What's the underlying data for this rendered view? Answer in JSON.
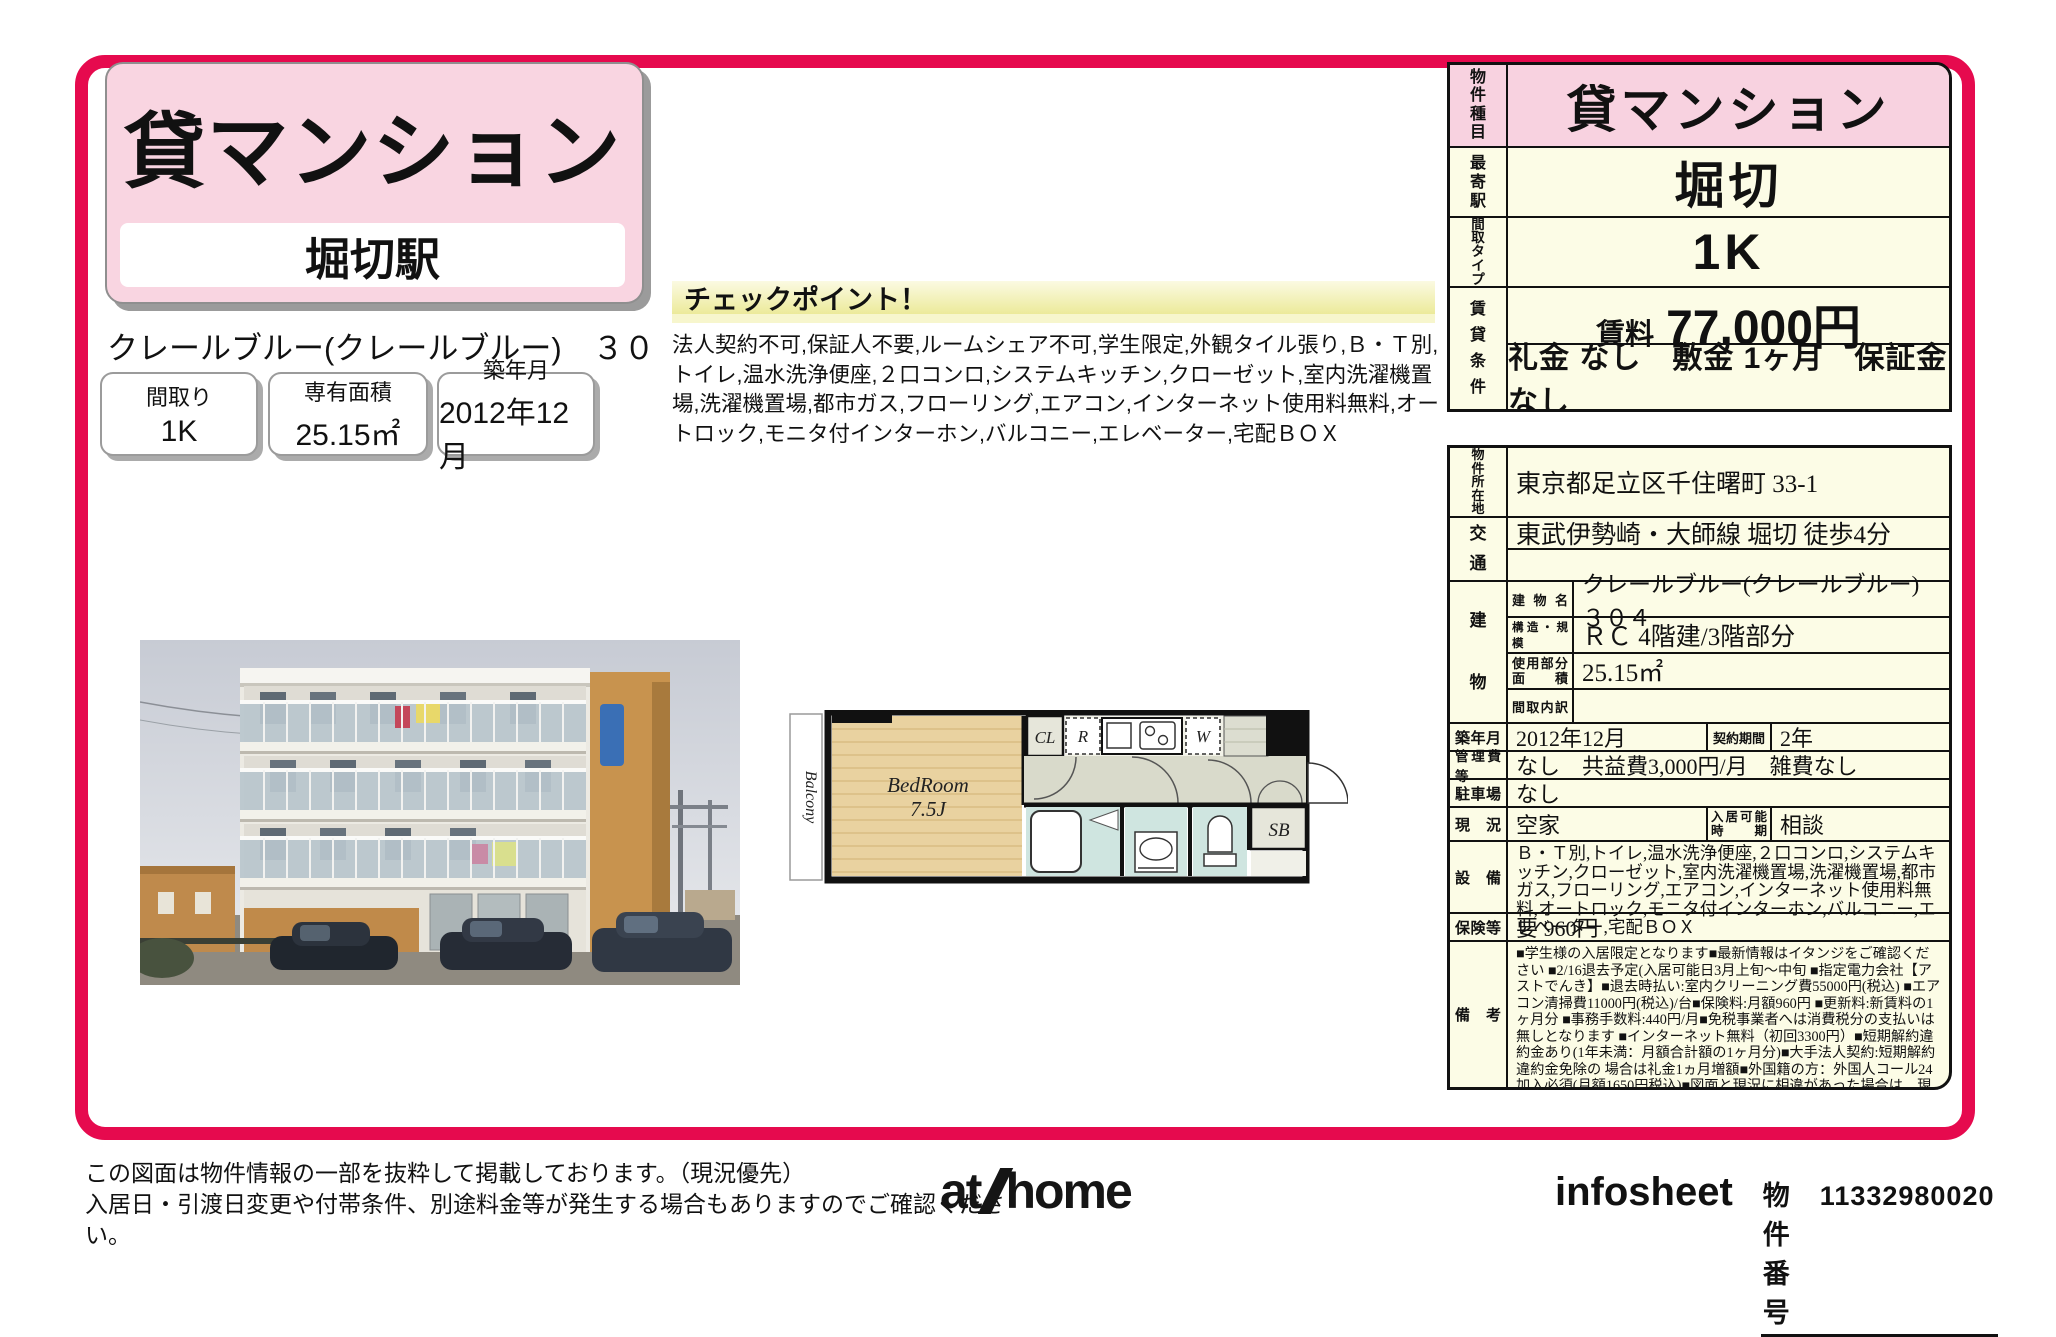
{
  "colors": {
    "accent_red": "#e60a4e",
    "title_pink": "#f9d5e1",
    "table_pink": "#f8d2e0",
    "table_cream": "#fcfce6",
    "checkpoint_yellow": "#ecea9a"
  },
  "header": {
    "property_type": "貸マンション",
    "station": "堀切駅",
    "property_name": "クレールブルー(クレールブルー)　３０４",
    "specs": [
      {
        "label": "間取り",
        "value": "1K"
      },
      {
        "label": "専有面積",
        "value": "25.15㎡"
      },
      {
        "label": "築年月",
        "value": "2012年12月"
      }
    ]
  },
  "checkpoint": {
    "title": "チェックポイント！",
    "body": "法人契約不可,保証人不要,ルームシェア不可,学生限定,外観タイル張り,Ｂ・Ｔ別,トイレ,温水洗浄便座,２口コンロ,システムキッチン,クローゼット,室内洗濯機置場,洗濯機置場,都市ガス,フローリング,エアコン,インターネット使用料無料,オートロック,モニタ付インターホン,バルコニー,エレベーター,宅配ＢＯＸ"
  },
  "summary": {
    "type_label": "物件種目",
    "type": "貸マンション",
    "station_label": "最寄駅",
    "station": "堀切",
    "layout_label": "間取タイプ",
    "layout": "1K",
    "terms_label": "賃貸条件",
    "rent_label": "賃料",
    "rent": "77,000円",
    "terms": "礼金 なし　敷金 1ヶ月　保証金 なし"
  },
  "detail": {
    "location_label": "物件所在地",
    "location": "東京都足立区千住曙町 33-1",
    "access_label": "交通",
    "access": "東武伊勢崎・大師線 堀切 徒歩4分",
    "access2": "",
    "building_label": "建物",
    "building_name_label": "建物名",
    "building_name": "クレールブルー(クレールブルー)　３０４",
    "structure_label": "構造・規模",
    "structure": "ＲＣ 4階建/3階部分",
    "area_label": "使用部分面積",
    "area": "25.15㎡",
    "layout_detail_label": "間取内訳",
    "layout_detail": "",
    "built_label": "築年月",
    "built": "2012年12月",
    "contract_label": "契約期間",
    "contract": "2年",
    "fees_label": "管理費等",
    "fees": "なし　共益費3,000円/月　雑費なし",
    "parking_label": "駐車場",
    "parking": "なし",
    "status_label": "現況",
    "status": "空家",
    "movein_label": "入居可能時期",
    "movein": "相談",
    "equipment_label": "設備",
    "equipment": "Ｂ・Ｔ別,トイレ,温水洗浄便座,２口コンロ,システムキッチン,クローゼット,室内洗濯機置場,洗濯機置場,都市ガス,フローリング,エアコン,インターネット使用料無料,オートロック,モニタ付インターホン,バルコニー,エレベーター,宅配ＢＯＸ",
    "insurance_label": "保険等",
    "insurance": "要 960円",
    "remarks_label": "備考",
    "remarks": "■学生様の入居限定となります■最新情報はイタンジをご確認ください ■2/16退去予定(入居可能日3月上旬～中旬 ■指定電力会社【アストでんき】■退去時払い:室内クリーニング費55000円(税込) ■エアコン清掃費11000円(税込)/台■保険料:月額960円 ■更新料:新賃料の1ヶ月分 ■事務手数料:440円/月■免税事業者へは消費税分の支払いは無しとなります ■インターネット無料（初回3300円）■短期解約違約金あり(1年未満：月額合計額の1ヶ月分)■大手法人契約:短期解約違約金免除の 場合は礼金1ヵ月増額■外国籍の方：外国人コール24加入必須(月額1650円税込)■図面と現況に相違があった場合は、現況優先とさせて頂きます ※駐輪場あり　安心サポート：1,870円/月　JF事務手数料：440円/月　町内会費：250円/月　更新料：新賃料１ヶ月　賃貸保証：加入要■初回60%（最低額30000円）・年間更新料10000円　■初回80%（最低額40000円）※各プラン月額事務手数料440円(税込)　鍵交換代等：有　27,500円～　利用駅１：京成本線 京成関屋 徒歩7分"
  },
  "floorplan": {
    "balcony": "Balcony",
    "bedroom": "BedRoom",
    "size": "7.5J",
    "closet": "CL",
    "fridge": "R",
    "washer": "W",
    "shoebox": "SB"
  },
  "footer": {
    "note1": "この図面は物件情報の一部を抜粋して掲載しております。（現況優先）",
    "note2": "入居日・引渡日変更や付帯条件、別途料金等が発生する場合もありますのでご確認ください。",
    "logo_at": "at",
    "logo_home": "home",
    "sheet": "infosheet",
    "pno_label": "物件番号",
    "pno": "11332980020"
  }
}
